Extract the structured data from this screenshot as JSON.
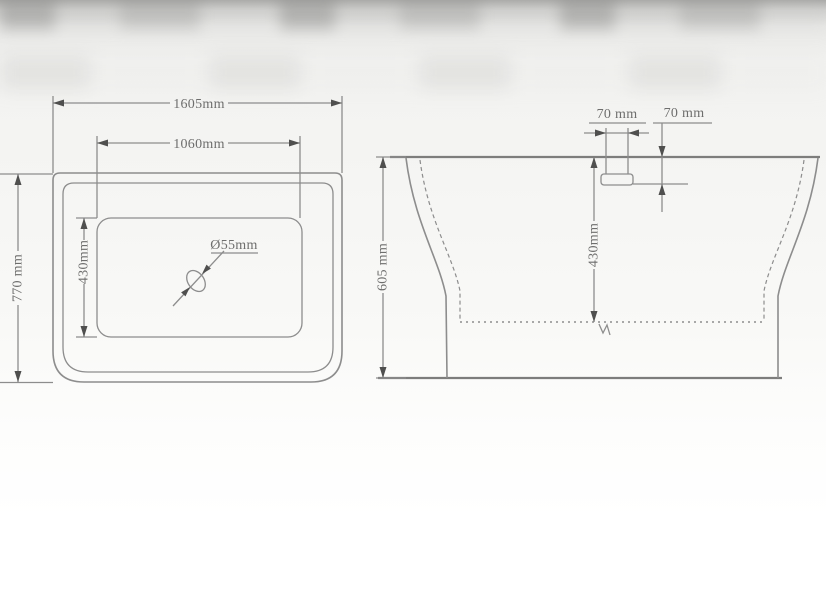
{
  "colors": {
    "line": "#8d8d8d",
    "line-dark": "#7d7d7c",
    "arrow": "#4f4f4e",
    "text": "#6e6e6d"
  },
  "drawing": {
    "subject": "bathtub technical dimension drawing",
    "top_view": {
      "outer_width": "1605mm",
      "inner_width": "1060mm",
      "outer_depth": "770 mm",
      "inner_depth": "430mm",
      "drain_diameter": "Ø55mm"
    },
    "side_view": {
      "overall_height": "605 mm",
      "inner_depth": "430mm",
      "overflow_width": "70 mm",
      "overflow_drop": "70 mm"
    }
  }
}
